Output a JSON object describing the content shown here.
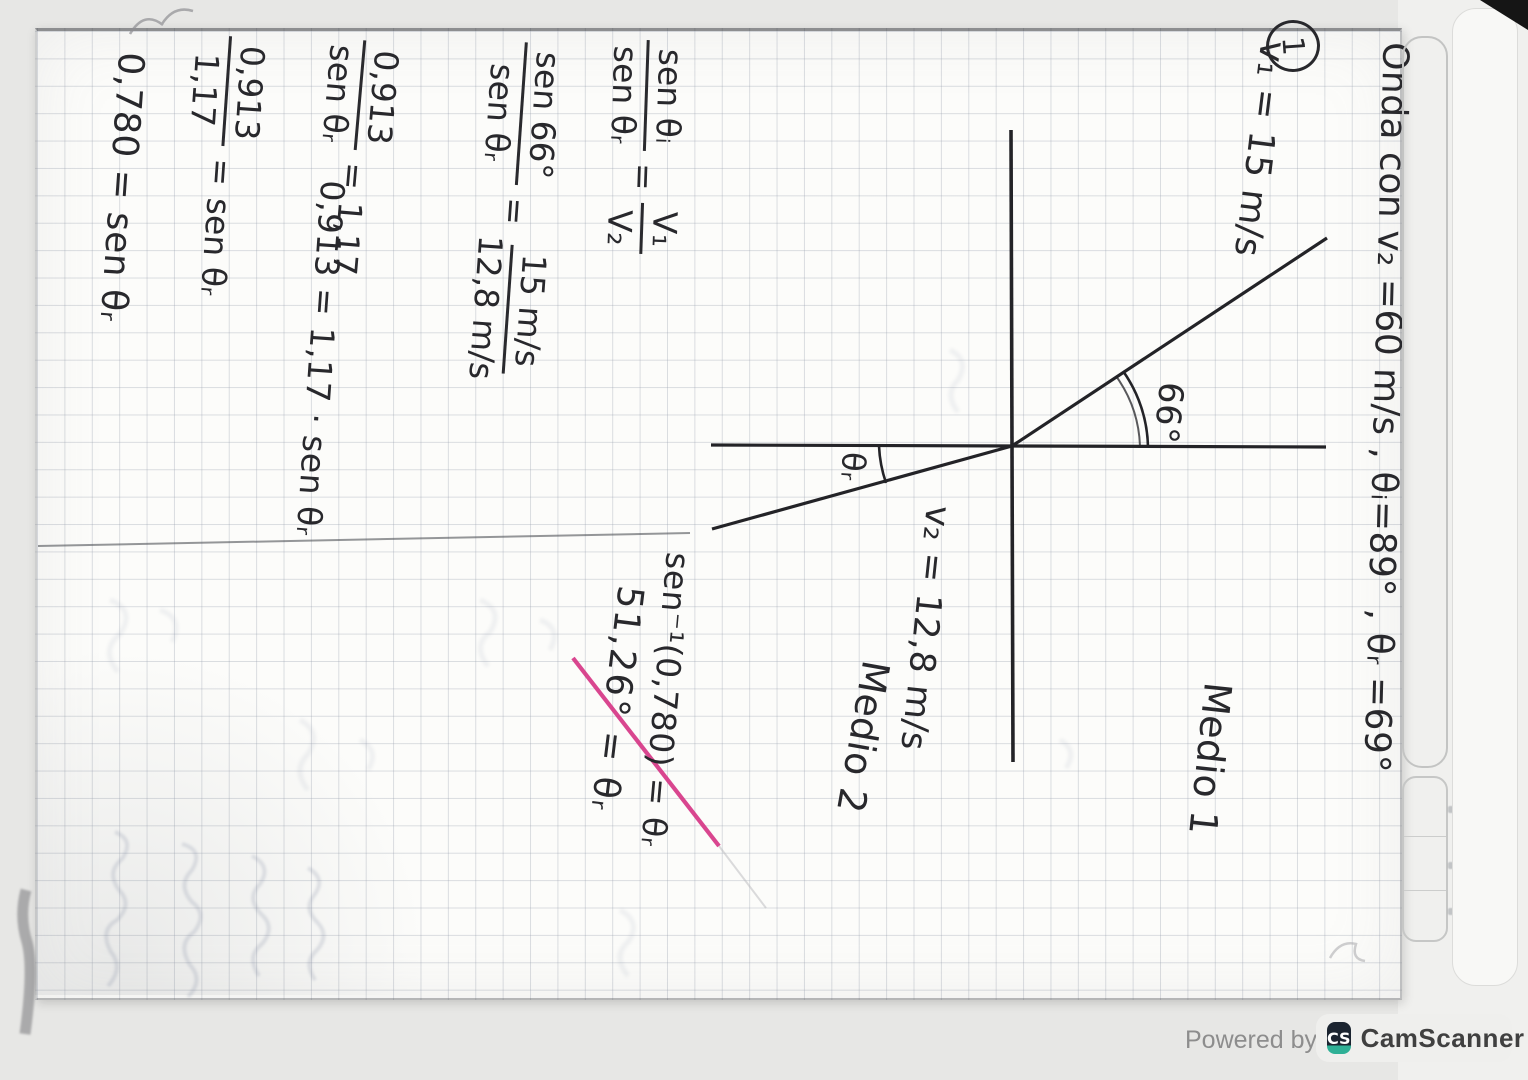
{
  "note": {
    "problem_number": "1",
    "heading": "Onda con v₂ =60 m/s , θᵢ=89° , θᵣ =69°",
    "given_v1": "v₁ = 15 m/s",
    "diagram": {
      "incidence_angle": "66°",
      "refraction_angle": "θᵣ",
      "medium1": "Medio 1",
      "medium2": "Medio 2",
      "velocity2": "v₂ = 12,8 m/s"
    },
    "work": {
      "snell": {
        "num1": "sen θᵢ",
        "den1": "sen θᵣ",
        "eq": "=",
        "num2": "V₁",
        "den2": "V₂"
      },
      "substitution": {
        "num1": "sen 66°",
        "den1": "sen θᵣ",
        "eq": "=",
        "num2": "15 m/s",
        "den2": "12,8 m/s"
      },
      "step3": {
        "num1": "0,913",
        "den1": "sen θᵣ",
        "eq": "=",
        "rhs": "1,17"
      },
      "step4": "0,913 = 1,17 · sen θᵣ",
      "step5": {
        "num1": "0,913",
        "den1": "1,17",
        "eq": "=",
        "rhs": "sen θᵣ"
      },
      "step6": "0,780 = sen θᵣ",
      "inverse": "sen⁻¹(0,780) = θᵣ",
      "result": "51,26° = θᵣ"
    }
  },
  "watermark": {
    "powered_by": "Powered by",
    "logo": "CS",
    "brand": "CamScanner"
  },
  "colors": {
    "ink": "#28282c",
    "highlight_pink": "#d63384",
    "paper": "#fcfcfa",
    "grid": "#98a0ae",
    "brand_dark": "#1b2430",
    "brand_teal": "#2fb096"
  }
}
